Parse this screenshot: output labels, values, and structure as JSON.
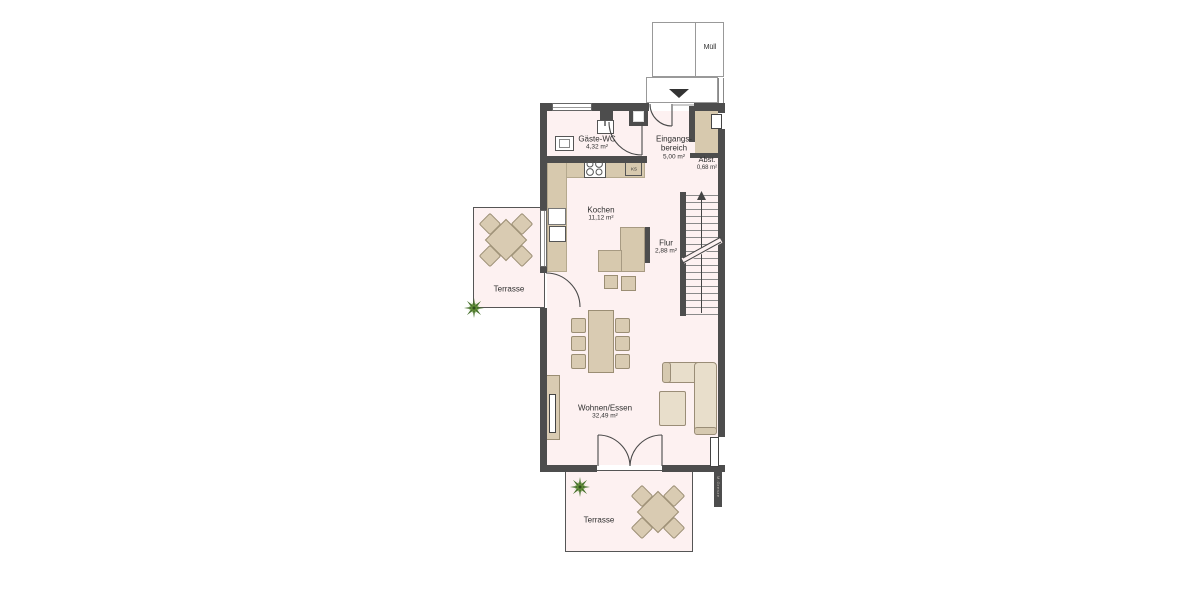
{
  "title": "Erdgeschoss Grundriss",
  "colors": {
    "wall": "#4d4d4d",
    "floor": "#fdf1f1",
    "furniture": "#d9cbb2",
    "sofa": "#e8decb",
    "counter": "#d7c9ae",
    "plant": "#45702a",
    "plant_light": "#6f9b3f",
    "text": "#2f2f2f"
  },
  "exterior": {
    "trash_label": "Müll"
  },
  "kitchen_items": {
    "fridge_label": "KS"
  },
  "watermark": "M.Grenze",
  "rooms": {
    "wc": {
      "name": "Gäste-WC",
      "area": "4,32 m²"
    },
    "entrance": {
      "name_line1": "Eingangs-",
      "name_line2": "bereich",
      "area": "5,00 m²"
    },
    "storage": {
      "name": "Abst.",
      "area": "0,68 m²"
    },
    "kitchen": {
      "name": "Kochen",
      "area": "11,12 m²"
    },
    "hall": {
      "name": "Flur",
      "area": "2,88 m²"
    },
    "living": {
      "name": "Wohnen/Essen",
      "area": "32,49 m²"
    },
    "terrace_left": {
      "name": "Terrasse"
    },
    "terrace_bottom": {
      "name": "Terrasse"
    }
  }
}
